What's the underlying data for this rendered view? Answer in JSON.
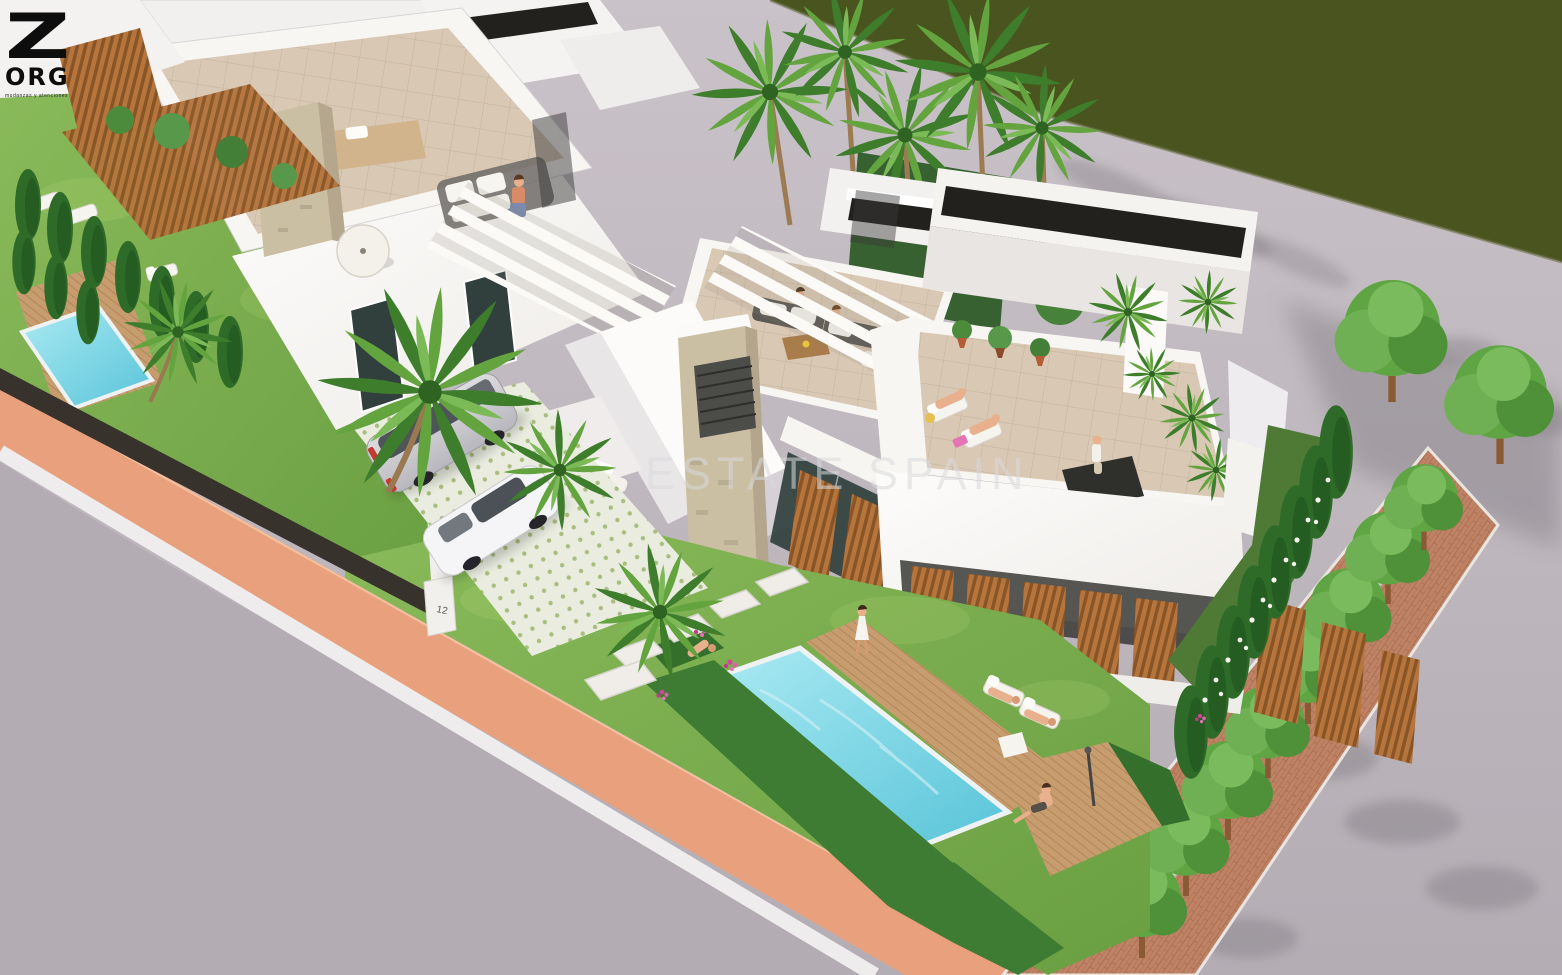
{
  "image": {
    "type": "3d-architectural-render",
    "subject": "Aerial 3D visualization of modern white villas with private pools, gardens, parked cars and a waterfront promenade",
    "width_px": 1562,
    "height_px": 975
  },
  "overlay": {
    "logo": {
      "letter": "Z",
      "name": "ORG",
      "tagline": "mudanzas y atenciones"
    },
    "watermark": "ESTATE SPAIN",
    "house_number": "12"
  },
  "palette": {
    "water": "#4a541f",
    "pavement": "#c2bbc2",
    "road": "#b3acb3",
    "curb": "#efecee",
    "walkway_terracotta": "#e9a17d",
    "brick_path": "#c08264",
    "gabion_wall": "#d7d3cc",
    "pool_water": "#6fd2e2",
    "lawn": "#7cb14e",
    "lawn_shaded": "#4e7a36",
    "hedge": "#3e7c33",
    "cypress": "#2e6b28",
    "villa_white": "#f8f6f3",
    "terrace_floor": "#d9c8b4",
    "stone_cladding": "#cbbfa3",
    "wood_louver": "#b5753d",
    "deck_wood": "#c79d6f",
    "roof_trim_dark": "#23211e",
    "glass_dark": "#31403d",
    "skin": "#e8b08c"
  }
}
